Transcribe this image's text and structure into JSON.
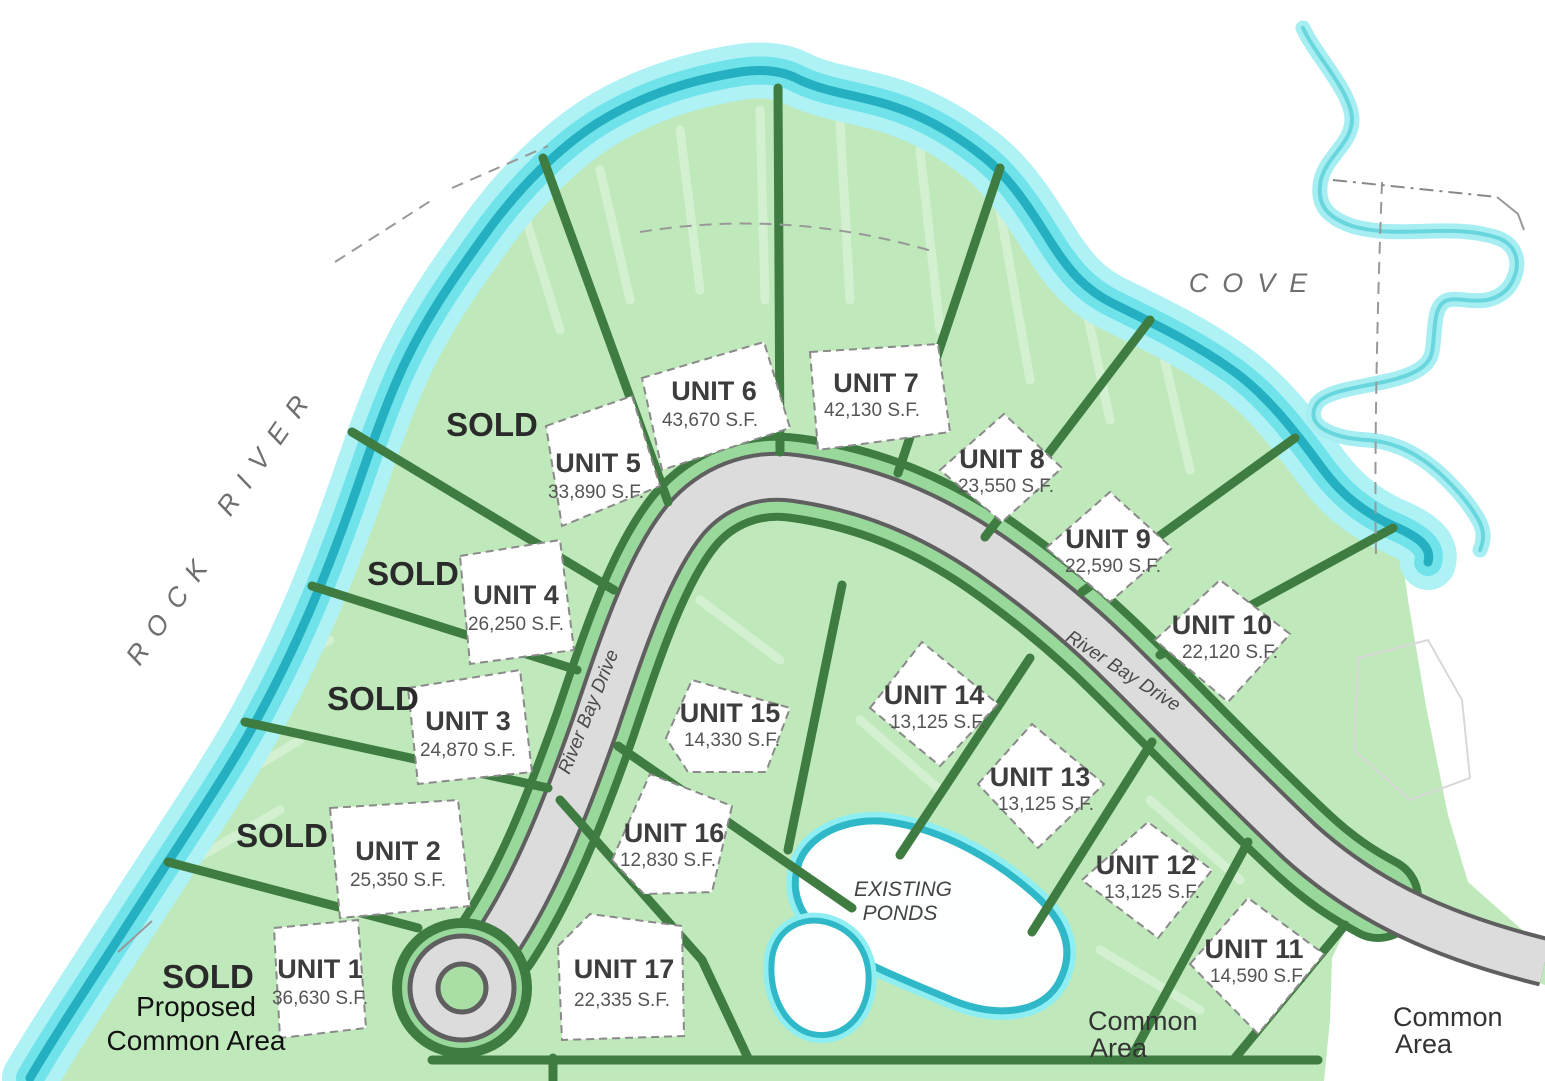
{
  "palette": {
    "land_green": "#bfe9bb",
    "verge_green": "#98d89a",
    "boundary_green": "#3f7c42",
    "water_cyan": "#7deaf0",
    "water_teal": "#2fb9c8",
    "road_gray": "#dcdcdc",
    "road_edge": "#5f5f5f"
  },
  "labels": {
    "river_word1": "ROCK",
    "river_word2": "RIVER",
    "cove": "COVE",
    "sold": "SOLD",
    "proposed_line1": "Proposed",
    "proposed_line2": "Common Area",
    "existing_ponds_line1": "EXISTING",
    "existing_ponds_line2": "PONDS",
    "common_area_line1": "Common",
    "common_area_line2": "Area",
    "road_name": "River Bay Drive"
  },
  "units": [
    {
      "name": "UNIT 1",
      "sf": "36,630 S.F."
    },
    {
      "name": "UNIT 2",
      "sf": "25,350 S.F."
    },
    {
      "name": "UNIT 3",
      "sf": "24,870 S.F."
    },
    {
      "name": "UNIT 4",
      "sf": "26,250 S.F."
    },
    {
      "name": "UNIT 5",
      "sf": "33,890 S.F."
    },
    {
      "name": "UNIT 6",
      "sf": "43,670 S.F."
    },
    {
      "name": "UNIT 7",
      "sf": "42,130 S.F."
    },
    {
      "name": "UNIT 8",
      "sf": "23,550 S.F."
    },
    {
      "name": "UNIT 9",
      "sf": "22,590 S.F."
    },
    {
      "name": "UNIT 10",
      "sf": "22,120 S.F."
    },
    {
      "name": "UNIT 11",
      "sf": "14,590 S.F."
    },
    {
      "name": "UNIT 12",
      "sf": "13,125 S.F."
    },
    {
      "name": "UNIT 13",
      "sf": "13,125 S.F."
    },
    {
      "name": "UNIT 14",
      "sf": "13,125 S.F."
    },
    {
      "name": "UNIT 15",
      "sf": "14,330 S.F."
    },
    {
      "name": "UNIT 16",
      "sf": "12,830 S.F."
    },
    {
      "name": "UNIT 17",
      "sf": "22,335 S.F."
    }
  ]
}
